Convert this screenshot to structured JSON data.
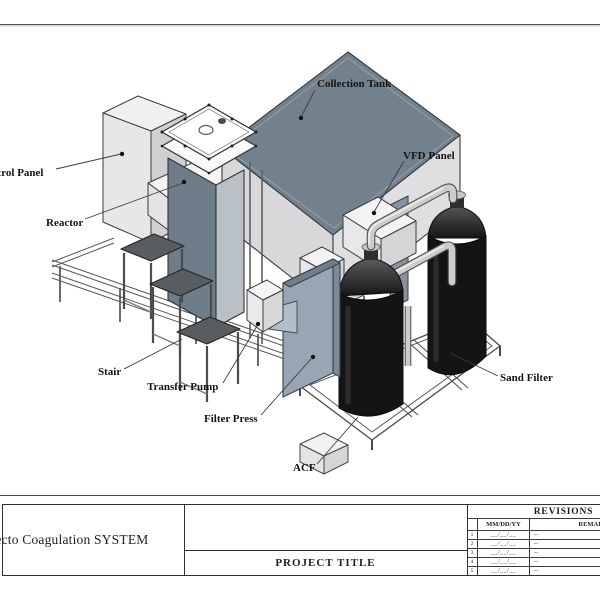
{
  "sheet": {
    "labels": {
      "control_panel": "Control Panel",
      "reactor": "Reactor",
      "collection_tank": "Collection Tank",
      "vfd_panel": "VFD Panel",
      "stair": "Stair",
      "transfer_pump": "Transfer Pump",
      "filter_press": "Filter Press",
      "acf": "ACF",
      "sand_filter": "Sand Filter"
    },
    "colors": {
      "tank_top": "#73818d",
      "reactor_front": "#6e7d89",
      "filter_press": "#97a6b2",
      "panel_slate": "#8593a0",
      "cylinder_body": "#141414",
      "pipe": "#cdcdc8",
      "stair_tread": "#585d62"
    },
    "title_block": {
      "system_title": "Electo Coagulation SYSTEM",
      "project_title": "PROJECT TITLE",
      "revisions": {
        "title": "REVISIONS",
        "date_header": "MM/DD/YY",
        "remarks_header": "REMARKS",
        "rows": [
          {
            "no": "1",
            "date": "__/__/__",
            "remarks": "--"
          },
          {
            "no": "2",
            "date": "__/__/__",
            "remarks": "--"
          },
          {
            "no": "3",
            "date": "__/__/__",
            "remarks": "--"
          },
          {
            "no": "4",
            "date": "__/__/__",
            "remarks": "--"
          },
          {
            "no": "5",
            "date": "__/__/__",
            "remarks": "--"
          }
        ]
      }
    }
  }
}
